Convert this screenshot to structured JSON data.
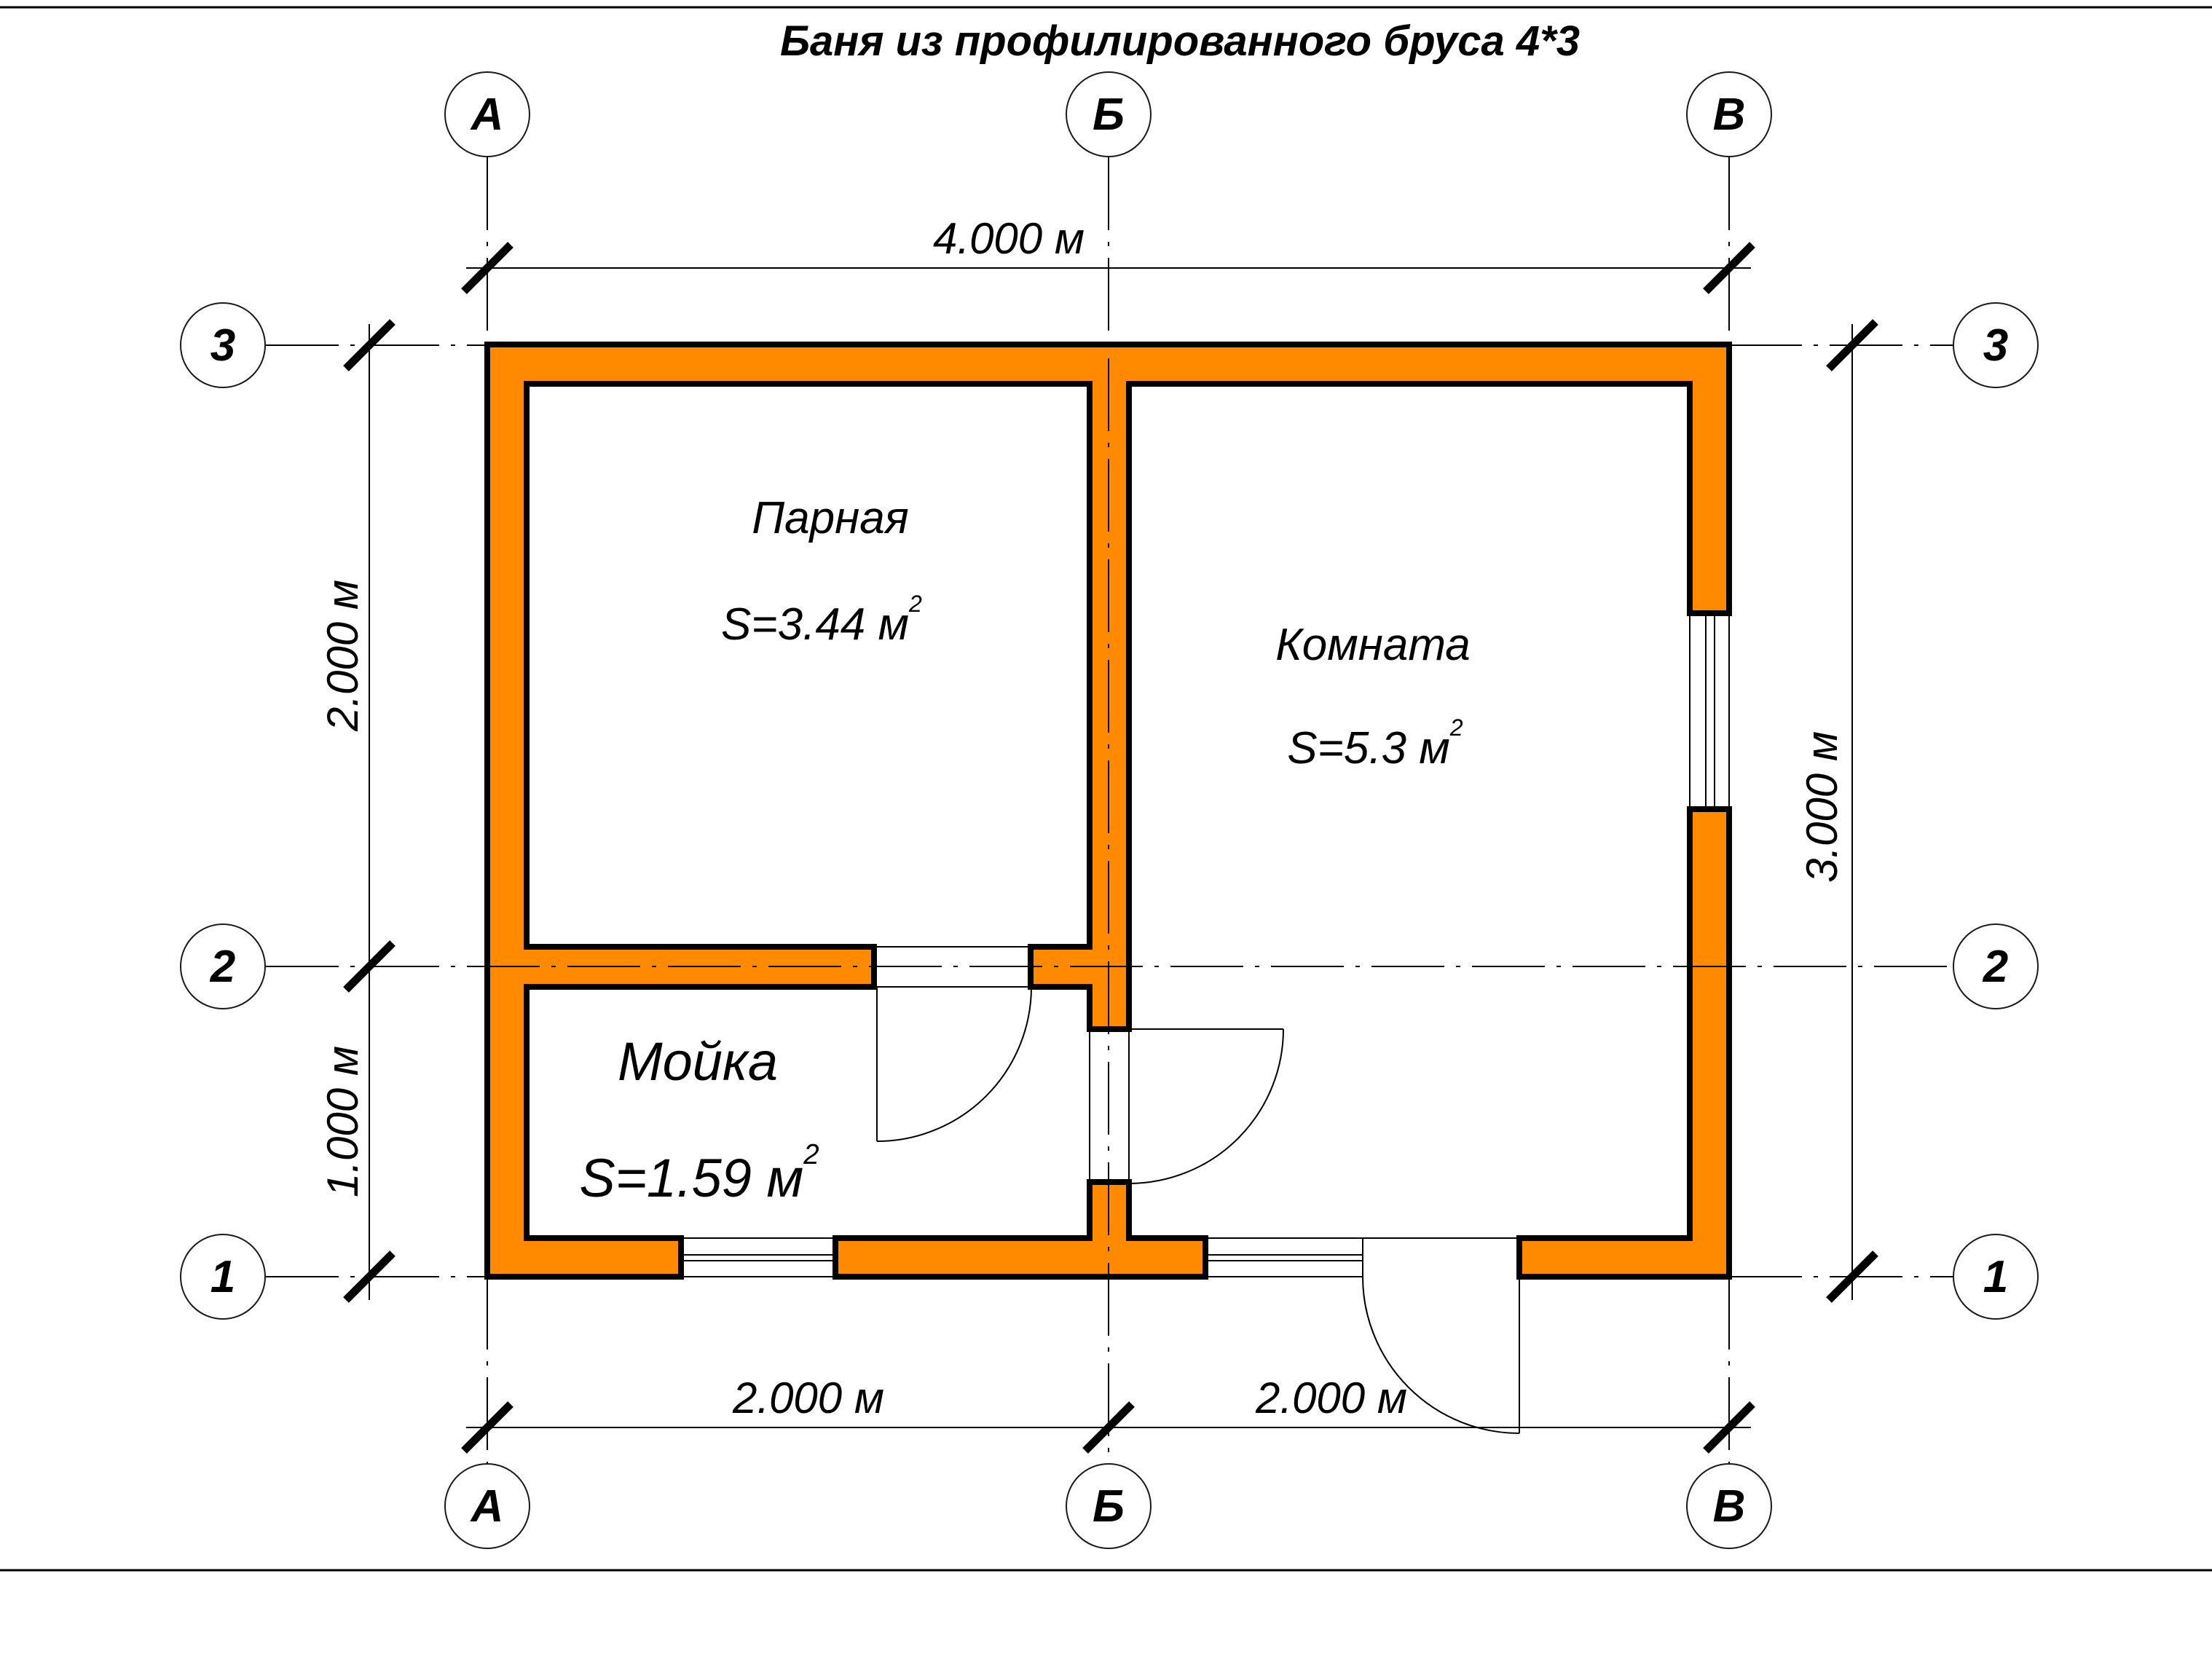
{
  "title": "Баня из профилированного бруса 4*3",
  "axes": {
    "top": [
      "А",
      "Б",
      "В"
    ],
    "bottom": [
      "А",
      "Б",
      "В"
    ],
    "left": [
      "3",
      "2",
      "1"
    ],
    "right": [
      "3",
      "2",
      "1"
    ]
  },
  "rooms": [
    {
      "name": "Парная",
      "area": "S=3.44 м",
      "area_sup": "2"
    },
    {
      "name": "Комната",
      "area": "S=5.3 м",
      "area_sup": "2"
    },
    {
      "name": "Мойка",
      "area": "S=1.59 м",
      "area_sup": "2"
    }
  ],
  "dimensions": {
    "top": "4.000 м",
    "bottom_left": "2.000 м",
    "bottom_right": "2.000 м",
    "left_upper": "2.000 м",
    "left_lower": "1.000 м",
    "right": "3.000 м"
  },
  "colors": {
    "wall_fill": "#FF8A00",
    "line": "#000000"
  }
}
